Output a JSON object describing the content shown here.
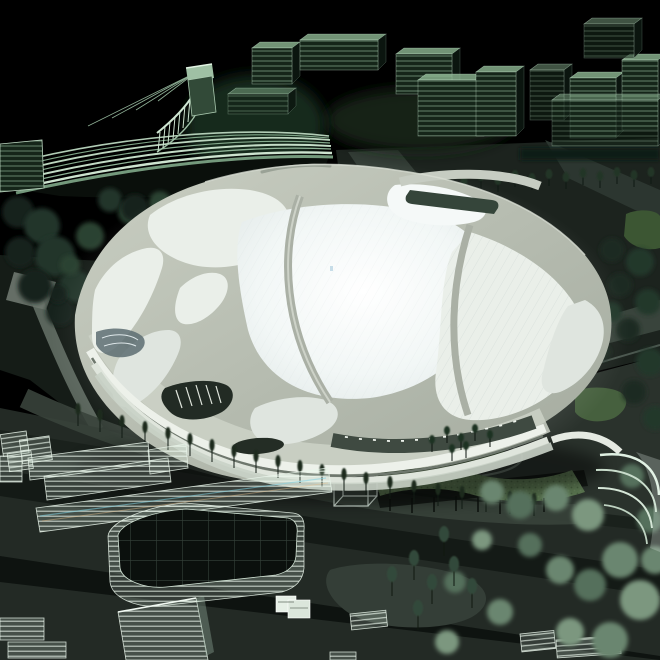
{
  "scene_description": "Night view of an illuminated architectural scale model: a white organic-shelled stadium glowing at center, surrounded by translucent green glass buildings, dark tree clusters, roads and landscaped plazas on a black background",
  "palette": {
    "bg": "#000000",
    "shell-hi": "#ccd1c5",
    "shell-lo": "#a6ada1",
    "panel-bright": "#f5f9f8",
    "panel-mid": "#eaefe9",
    "panel-dim": "#dfe5df",
    "rib-shadow": "#939b90",
    "facade-dark": "#2a332b",
    "glass-green-hi": "#cfe9d4",
    "glass-green": "#9dc4a6",
    "glass-top": "#8fb894",
    "glass-side": "#0c1711",
    "city-front-bg": "#152519",
    "ground-dark": "#0d120f",
    "ground-mid": "#1c231e",
    "ground-deck": "#2a322c",
    "road-dark": "#111713",
    "path-light": "#5d685f",
    "tree-dark": "#1d2c21",
    "tree-mid": "#2c4232",
    "tree-sage": "#67836d",
    "lawn": "#4e6a42",
    "lawn-dark": "#2f4628",
    "acrylic-edge": "#e9f4ea"
  },
  "scene": {
    "city_buildings": {
      "shape": "building",
      "items": [
        [
          252,
          48,
          40,
          36,
          0
        ],
        [
          300,
          40,
          78,
          30,
          0
        ],
        [
          396,
          54,
          56,
          40,
          0
        ],
        [
          228,
          94,
          60,
          20,
          1
        ],
        [
          418,
          80,
          66,
          56,
          0
        ],
        [
          476,
          72,
          40,
          64,
          0
        ],
        [
          530,
          70,
          34,
          50,
          1
        ],
        [
          570,
          78,
          46,
          60,
          0
        ],
        [
          622,
          60,
          36,
          70,
          0
        ],
        [
          552,
          100,
          106,
          46,
          1
        ],
        [
          584,
          24,
          50,
          34,
          1
        ]
      ]
    },
    "city_row_trees": {
      "shape": "tree",
      "trunk": 9,
      "rx": 3.4,
      "ry": 5,
      "color": "#0e1812",
      "canopy": "#223526",
      "items": [
        [
          345,
          198
        ],
        [
          362,
          196
        ],
        [
          379,
          194
        ],
        [
          396,
          196
        ],
        [
          413,
          192
        ],
        [
          430,
          195
        ],
        [
          447,
          190
        ],
        [
          464,
          193
        ],
        [
          481,
          188
        ],
        [
          498,
          192
        ],
        [
          515,
          187
        ],
        [
          532,
          190
        ],
        [
          549,
          186
        ],
        [
          566,
          189
        ],
        [
          583,
          185
        ],
        [
          600,
          188
        ],
        [
          617,
          184
        ],
        [
          634,
          187
        ],
        [
          651,
          184
        ]
      ]
    },
    "stand_canopy_blobs": {
      "shape": "blob",
      "soft": true,
      "colors": [
        "#16231a",
        "#22352a",
        "#2b4231"
      ],
      "items": [
        [
          18,
          212,
          16,
          0
        ],
        [
          42,
          226,
          18,
          1
        ],
        [
          20,
          252,
          15,
          0
        ],
        [
          55,
          256,
          20,
          1
        ],
        [
          90,
          236,
          14,
          2
        ],
        [
          35,
          286,
          17,
          0
        ],
        [
          75,
          286,
          16,
          1
        ],
        [
          110,
          266,
          13,
          2
        ],
        [
          60,
          312,
          14,
          0
        ],
        [
          100,
          302,
          12,
          1
        ],
        [
          130,
          212,
          12,
          2
        ],
        [
          152,
          230,
          10,
          0
        ],
        [
          70,
          265,
          10,
          2
        ],
        [
          58,
          294,
          9,
          0
        ],
        [
          110,
          200,
          12,
          1
        ],
        [
          135,
          208,
          14,
          0
        ],
        [
          160,
          202,
          11,
          2
        ],
        [
          185,
          210,
          13,
          1
        ],
        [
          210,
          206,
          12,
          0
        ],
        [
          235,
          212,
          12,
          1
        ],
        [
          258,
          208,
          11,
          2
        ],
        [
          282,
          214,
          12,
          0
        ],
        [
          305,
          211,
          10,
          1
        ],
        [
          325,
          216,
          10,
          0
        ]
      ]
    },
    "right_edge_blobs": {
      "shape": "blob",
      "soft": true,
      "colors": [
        "#1b2a20",
        "#24382a"
      ],
      "items": [
        [
          612,
          250,
          12,
          0
        ],
        [
          640,
          262,
          14,
          1
        ],
        [
          620,
          285,
          12,
          0
        ],
        [
          648,
          302,
          13,
          1
        ],
        [
          628,
          330,
          12,
          0
        ],
        [
          650,
          362,
          14,
          1
        ],
        [
          634,
          392,
          12,
          0
        ],
        [
          655,
          418,
          12,
          1
        ],
        [
          612,
          312,
          10,
          1
        ],
        [
          602,
          352,
          9,
          0
        ]
      ]
    },
    "front_trees": {
      "shape": "tree",
      "trunk": 13,
      "rx": 2.6,
      "ry": 6,
      "color": "#101a13",
      "canopy": "#1c2a1f",
      "items": [
        [
          78,
          426
        ],
        [
          100,
          432
        ],
        [
          122,
          438
        ],
        [
          145,
          444
        ],
        [
          168,
          450
        ],
        [
          190,
          456
        ],
        [
          212,
          462
        ],
        [
          234,
          468
        ],
        [
          256,
          473
        ],
        [
          278,
          478
        ],
        [
          300,
          483
        ],
        [
          322,
          487
        ],
        [
          344,
          491
        ],
        [
          366,
          495
        ],
        [
          390,
          499
        ],
        [
          414,
          503
        ],
        [
          438,
          506
        ],
        [
          462,
          509
        ],
        [
          486,
          512
        ],
        [
          510,
          514
        ],
        [
          534,
          516
        ]
      ]
    },
    "mound_trees": {
      "shape": "tree",
      "trunk": 10,
      "rx": 3,
      "ry": 4.5,
      "color": "#0c140e",
      "canopy": "#1f3322",
      "items": [
        [
          432,
          452
        ],
        [
          447,
          443
        ],
        [
          461,
          450
        ],
        [
          475,
          441
        ],
        [
          490,
          447
        ],
        [
          452,
          461
        ],
        [
          466,
          458
        ]
      ]
    },
    "median_trees": {
      "shape": "tree",
      "trunk": 16,
      "rx": 5,
      "ry": 8,
      "color": "#10180f",
      "canopy": "#33493a",
      "items": [
        [
          392,
          596
        ],
        [
          414,
          580
        ],
        [
          432,
          604
        ],
        [
          454,
          586
        ],
        [
          472,
          608
        ],
        [
          418,
          630
        ],
        [
          444,
          556
        ]
      ]
    },
    "sage_blobs": {
      "shape": "blob",
      "soft": true,
      "colors": [
        "#6a8670",
        "#55705c",
        "#7b977f"
      ],
      "items": [
        [
          492,
          492,
          12,
          0
        ],
        [
          520,
          505,
          14,
          1
        ],
        [
          556,
          498,
          13,
          0
        ],
        [
          588,
          515,
          16,
          2
        ],
        [
          620,
          560,
          18,
          0
        ],
        [
          590,
          585,
          16,
          1
        ],
        [
          640,
          600,
          20,
          2
        ],
        [
          560,
          570,
          14,
          0
        ],
        [
          530,
          545,
          12,
          1
        ],
        [
          610,
          640,
          18,
          0
        ],
        [
          570,
          632,
          14,
          2
        ],
        [
          650,
          520,
          13,
          1
        ],
        [
          482,
          540,
          10,
          2
        ],
        [
          455,
          582,
          11,
          1
        ],
        [
          500,
          612,
          13,
          0
        ],
        [
          447,
          642,
          12,
          2
        ],
        [
          632,
          476,
          12,
          1
        ],
        [
          655,
          560,
          14,
          0
        ]
      ]
    },
    "facade_windows": {
      "shape": "rect",
      "fill": "#eef3ec",
      "items": [
        [
          345,
          436,
          3,
          1.8,
          6
        ],
        [
          359,
          438,
          3,
          1.8,
          5
        ],
        [
          373,
          439,
          3,
          1.8,
          4
        ],
        [
          387,
          440,
          3,
          1.8,
          3
        ],
        [
          401,
          440,
          3,
          1.8,
          1
        ],
        [
          415,
          439,
          3,
          1.8,
          0
        ],
        [
          429,
          438,
          3,
          1.8,
          -2
        ],
        [
          443,
          436,
          3,
          1.8,
          -4
        ],
        [
          457,
          434,
          3,
          1.8,
          -6
        ],
        [
          471,
          431,
          3,
          1.8,
          -8
        ],
        [
          485,
          428,
          3,
          1.8,
          -10
        ],
        [
          499,
          425,
          3,
          1.8,
          -12
        ],
        [
          513,
          421,
          3,
          1.8,
          -14
        ]
      ]
    },
    "stand_fins": {
      "shape": "line",
      "stroke": "#cfe6d2",
      "w": 1,
      "items": [
        [
          160,
          132,
          158,
          152
        ],
        [
          165,
          127,
          163,
          148
        ],
        [
          170,
          122,
          168,
          144
        ],
        [
          175,
          117,
          173,
          139
        ],
        [
          180,
          111,
          178,
          134
        ],
        [
          185,
          105,
          183,
          128
        ],
        [
          190,
          99,
          188,
          122
        ],
        [
          195,
          93,
          193,
          116
        ],
        [
          200,
          87,
          198,
          110
        ]
      ]
    },
    "stand_cables": {
      "shape": "line",
      "stroke": "#8fb096",
      "w": 0.8,
      "items": [
        [
          195,
          73,
          88,
          126
        ],
        [
          195,
          73,
          112,
          118
        ],
        [
          195,
          73,
          136,
          110
        ],
        [
          195,
          73,
          158,
          101
        ]
      ]
    },
    "plaza_dots": {
      "shape": "blob",
      "colors": [
        "#e8efe7"
      ],
      "items": [
        [
          518,
          243,
          2.2,
          0
        ],
        [
          476,
          300,
          1.8,
          0
        ],
        [
          540,
          296,
          1.8,
          0
        ]
      ]
    }
  }
}
